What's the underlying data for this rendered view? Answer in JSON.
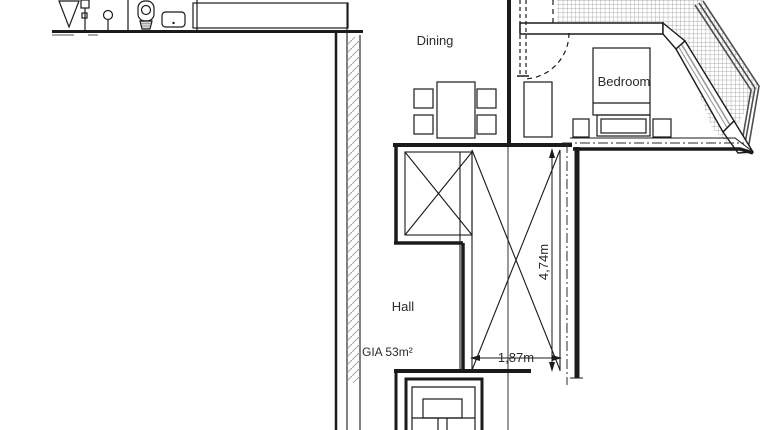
{
  "rooms": {
    "dining": "Dining",
    "bedroom": "Bedroom",
    "hall": "Hall"
  },
  "labels": {
    "gia": "GIA 53m²"
  },
  "dimensions": {
    "height": "4,74m",
    "width": "1,87m"
  },
  "icons": [
    "shower-screen-icon",
    "towel-post-icon",
    "toilet-icon",
    "sink-icon",
    "dining-table-icon",
    "dining-chair-icon",
    "bed-icon",
    "nightstand-icon",
    "wardrobe-icon",
    "door-swing-icon",
    "staircase-icon",
    "terrace-decking-hatch",
    "terrace-railing",
    "void-cross-marks"
  ],
  "colors": {
    "line": "#1b1b1b",
    "railing": "#4f4f4f",
    "terrace_hatch": "#8f8f8f",
    "wall_hatch": "#9a9a9a",
    "glazing": "#999999",
    "background": "#ffffff"
  }
}
